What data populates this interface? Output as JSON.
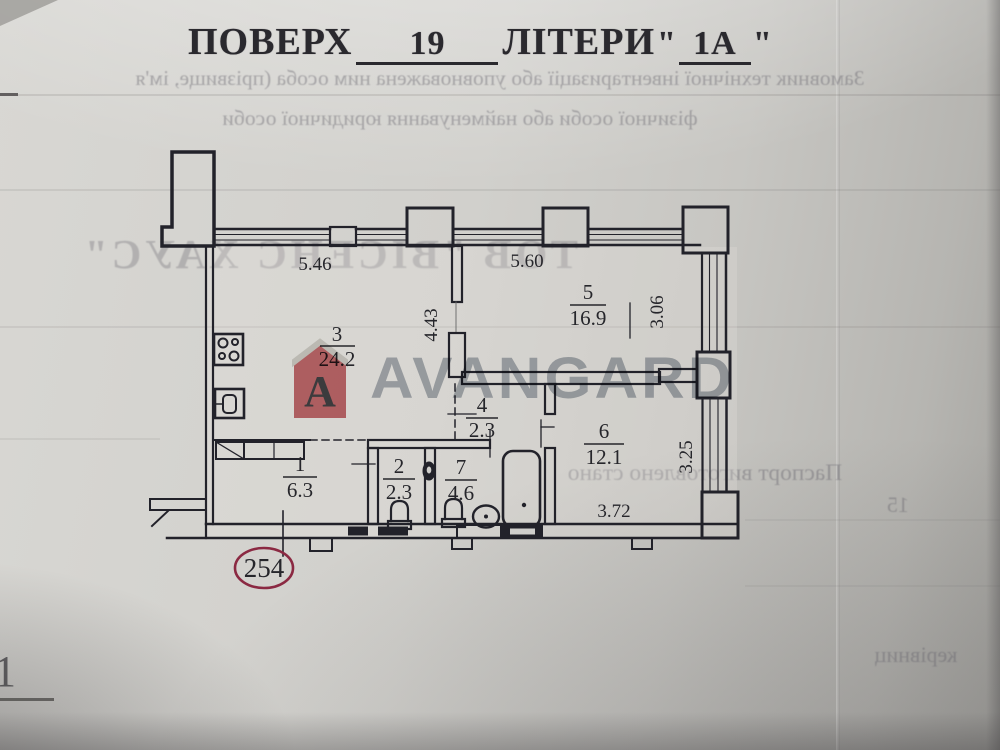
{
  "header": {
    "floor_label": "ПОВЕРХ",
    "floor_value": "19",
    "letters_label": "ЛІТЕРИ",
    "open_quote": "\"",
    "letters_value": "1А",
    "close_quote": "\""
  },
  "plan": {
    "apartment_number": "254",
    "rooms": [
      {
        "number": "1",
        "area": "6.3"
      },
      {
        "number": "2",
        "area": "2.3"
      },
      {
        "number": "3",
        "area": "24.2"
      },
      {
        "number": "4",
        "area": "2.3"
      },
      {
        "number": "5",
        "area": "16.9"
      },
      {
        "number": "6",
        "area": "12.1"
      },
      {
        "number": "7",
        "area": "4.6"
      }
    ],
    "dimensions": {
      "top_left": "5.46",
      "top_right": "5.60",
      "mid_vertical": "4.43",
      "right_upper": "3.06",
      "right_lower": "3.25",
      "bottom": "3.72"
    }
  },
  "watermark": {
    "brand": "AVANGARD",
    "logo_letter": "A",
    "logo_color": "#c4565c",
    "brand_text_color": "#747f8c"
  },
  "colors": {
    "ink": "#26262b",
    "badge_ellipse": "#8b2942"
  },
  "bleedthrough": {
    "line1": "Замовник технічної інвентаризації або уповноважена ним особа (прізвище, ім'я",
    "line2": "фізичної особи або найменування юридичної особи",
    "company": "ТОВ \"ВІСЕНС ХАУС\"",
    "line3": "Паспорт виготовлено стано",
    "line4": "15",
    "line5": "керівниц",
    "corner_mark": "1"
  }
}
